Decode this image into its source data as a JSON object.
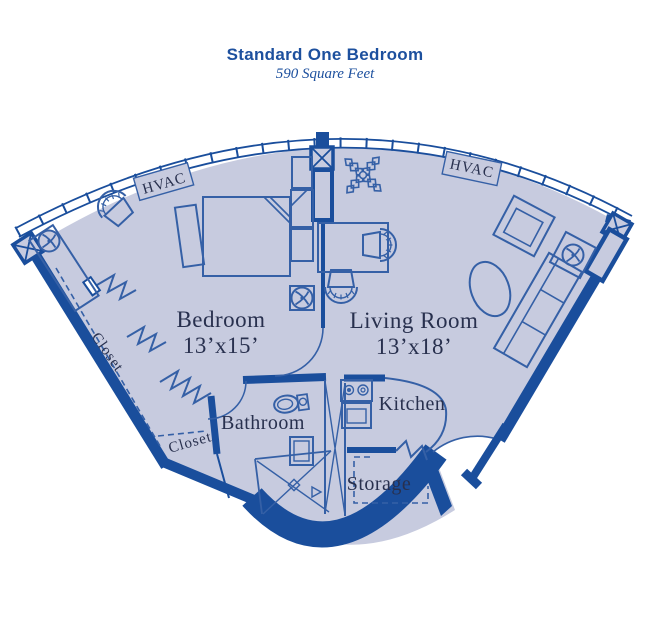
{
  "header": {
    "title": "Standard One Bedroom",
    "subtitle": "590 Square Feet"
  },
  "rooms": {
    "bedroom": {
      "name": "Bedroom",
      "dims": "13’x15’"
    },
    "living": {
      "name": "Living Room",
      "dims": "13’x18’"
    },
    "bathroom": {
      "name": "Bathroom"
    },
    "kitchen": {
      "name": "Kitchen"
    },
    "storage": {
      "name": "Storage"
    }
  },
  "labels": {
    "hvac": "HVAC",
    "closet": "Closet"
  },
  "colors": {
    "wall": "#1a4e9c",
    "room_fill": "#c7cbdf",
    "furniture_line": "#3560a6",
    "label_text": "#28304e",
    "title_text": "#1d509e",
    "background": "#ffffff"
  }
}
